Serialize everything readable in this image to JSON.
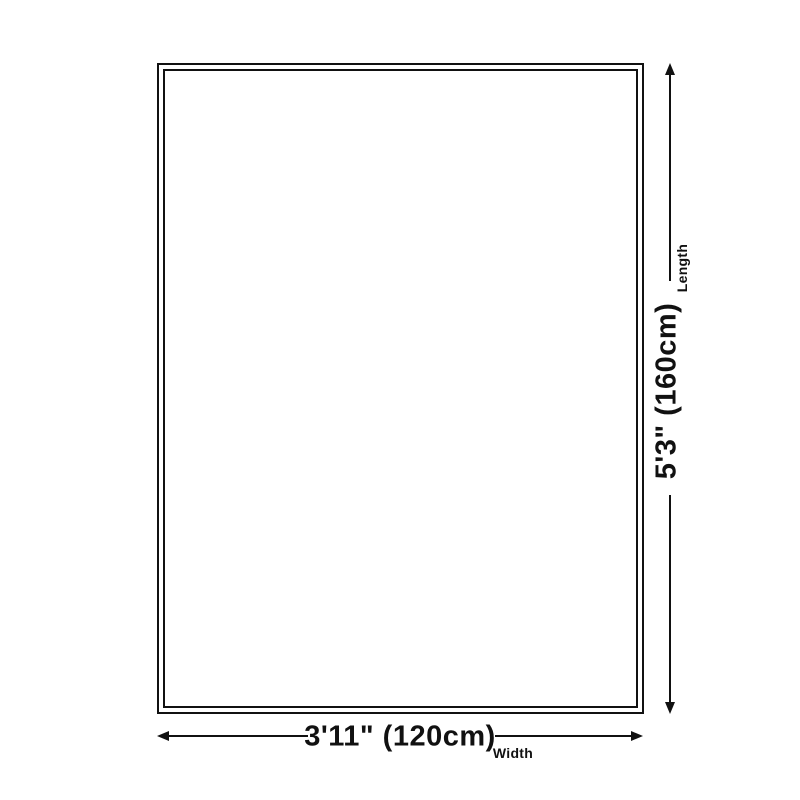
{
  "diagram": {
    "type": "product-dimension-diagram",
    "colors": {
      "ink": "#111111",
      "background": "#ffffff"
    },
    "length": {
      "value": "5'3\" (160cm)",
      "caption": "Length"
    },
    "width": {
      "value": "3'11\" (120cm)",
      "caption": "Width"
    }
  }
}
